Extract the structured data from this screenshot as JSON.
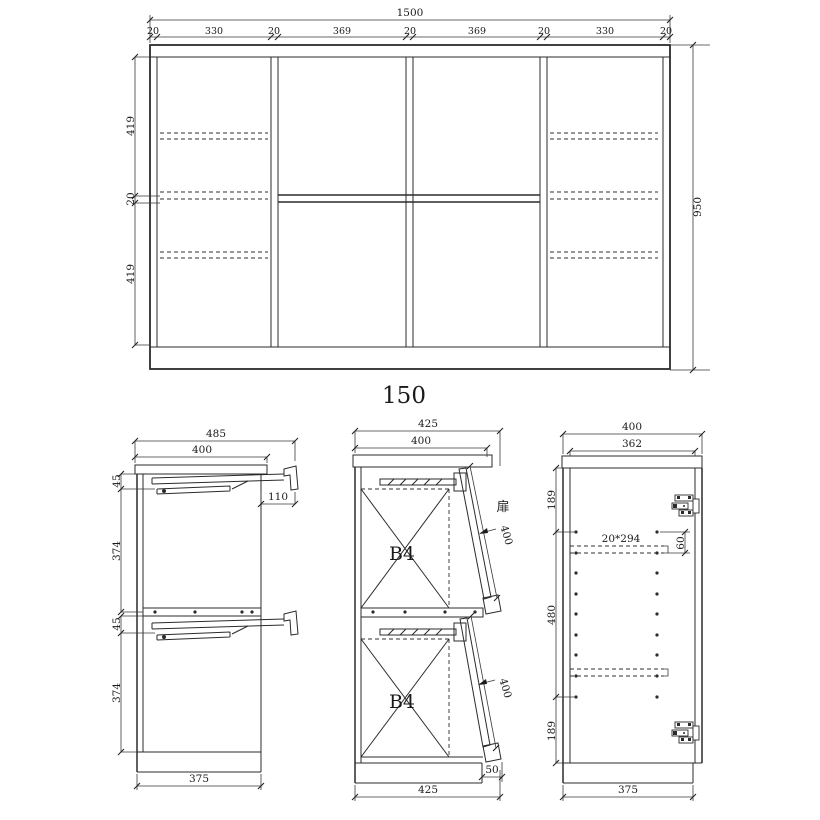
{
  "drawing": {
    "title": "150",
    "front": {
      "width_total": "1500",
      "height_total": "950",
      "top_chain": [
        "20",
        "330",
        "20",
        "369",
        "20",
        "369",
        "20",
        "330",
        "20"
      ],
      "left_chain": [
        "419",
        "20",
        "419"
      ]
    },
    "side_left": {
      "top_total": "485",
      "top_inner": "400",
      "gap_upper": "45",
      "door_overhang": "110",
      "height_upper": "374",
      "gap_lower": "45",
      "height_lower": "374",
      "bottom_width": "375"
    },
    "section_mid": {
      "top_total": "425",
      "top_inner": "400",
      "door_label": "扉",
      "door_len_upper": "400",
      "door_len_lower": "400",
      "paper_upper": "B4",
      "paper_lower": "B4",
      "bottom_offset": "50",
      "bottom_width": "425"
    },
    "side_right": {
      "top_total": "400",
      "top_inner": "362",
      "seg_upper": "189",
      "seg_mid": "480",
      "seg_lower": "189",
      "pitch_label": "20*294",
      "shelf_dim": "60",
      "bottom_width": "375"
    }
  }
}
